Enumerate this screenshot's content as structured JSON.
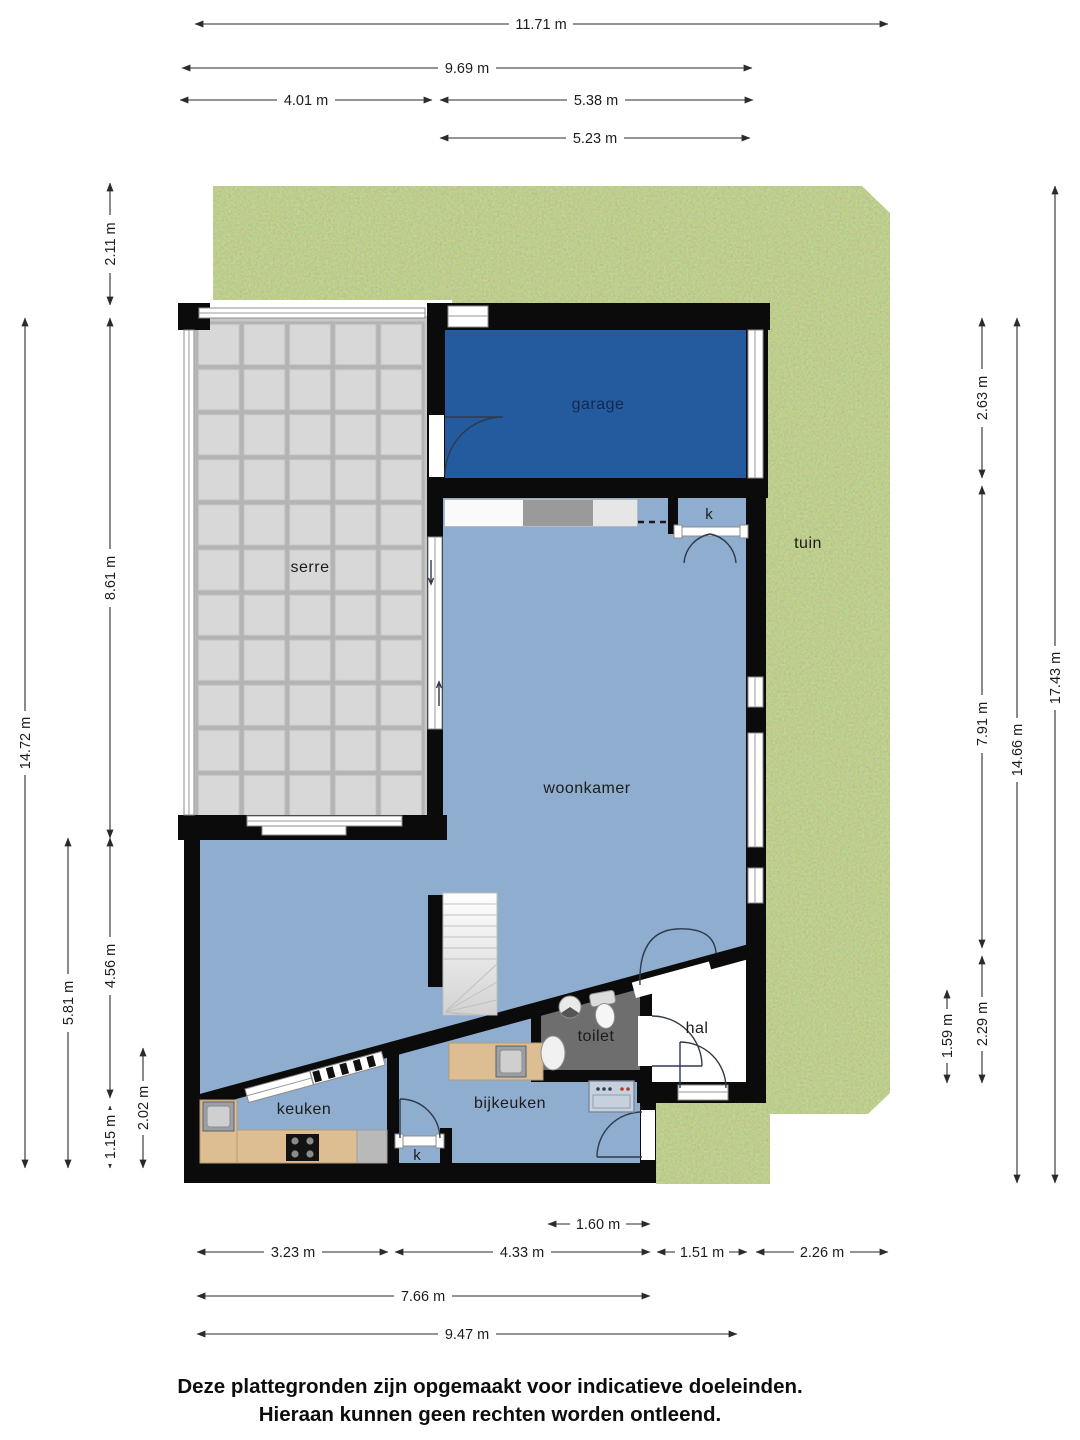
{
  "rooms": {
    "serre": "serre",
    "garage": "garage",
    "tuin": "tuin",
    "woonkamer": "woonkamer",
    "keuken": "keuken",
    "bijkeuken": "bijkeuken",
    "toilet": "toilet",
    "hal": "hal",
    "closet_top": "k",
    "closet_bottom": "k"
  },
  "dims": {
    "top_total": "11.71 m",
    "top_inner": "9.69 m",
    "top_serre": "4.01 m",
    "top_garage": "5.38 m",
    "top_garage_inner": "5.23 m",
    "left_setback": "2.11 m",
    "left_serre": "8.61 m",
    "left_total": "14.72 m",
    "left_lower": "5.81 m",
    "left_woonkamer": "4.56 m",
    "left_keuken": "1.15 m",
    "left_keuken_depth": "2.02 m",
    "right_garage": "2.63 m",
    "right_woonkamer": "7.91 m",
    "right_hal": "2.29 m",
    "right_entree": "1.59 m",
    "right_house": "14.66 m",
    "right_total": "17.43 m",
    "bottom_kast": "1.60 m",
    "bottom_keuken": "3.23 m",
    "bottom_bijkeuken": "4.33 m",
    "bottom_hal": "1.51 m",
    "bottom_tuin": "2.26 m",
    "bottom_inner": "7.66 m",
    "bottom_total": "9.47 m"
  },
  "footer": {
    "line1": "Deze plattegronden zijn opgemaakt voor indicatieve doeleinden.",
    "line2": "Hieraan kunnen geen rechten worden ontleend."
  },
  "colors": {
    "grass": "#7d9a44",
    "floor": "#8fadce",
    "garage": "#245a9e",
    "toilet_floor": "#6e6e6e",
    "hal_floor": "#ffffff",
    "wall": "#0b0b0b",
    "wood": "#ddbd92",
    "counter_gray": "#9a9a9a",
    "glass_panel": "#d8d8d8",
    "stairs": "#ececec",
    "text": "#1c1c1c",
    "garage_text": "#15284e"
  }
}
